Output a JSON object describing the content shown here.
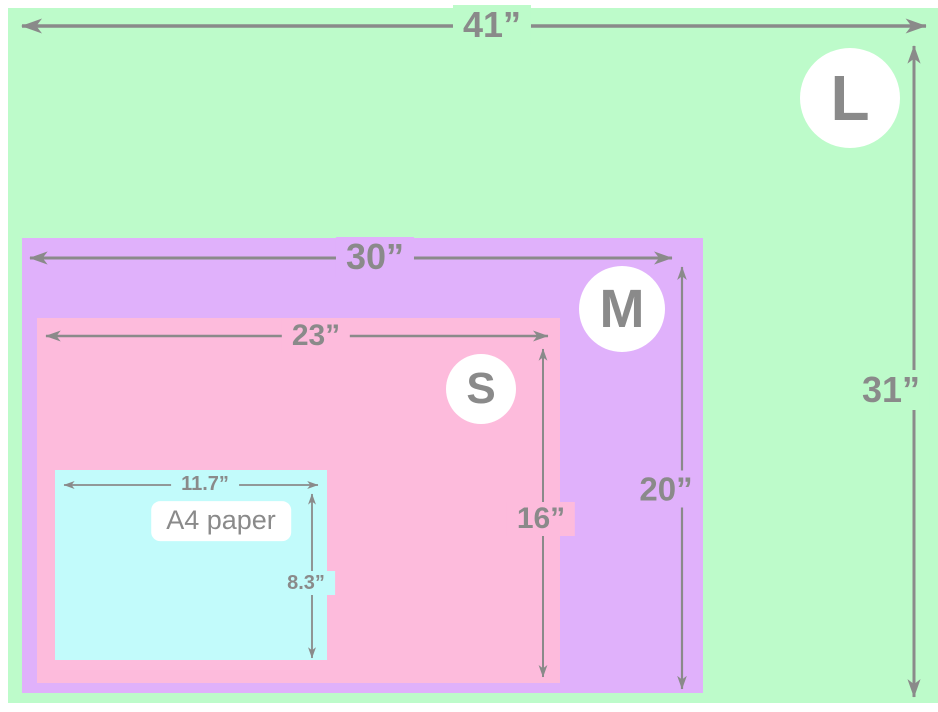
{
  "title": "Size comparison diagram with nested rectangles and A4 paper reference",
  "colors": {
    "background": "#ffffff",
    "size_l": "#bdfbca",
    "size_m": "#e0b1fb",
    "size_s": "#fdbbdc",
    "a4": "#c2fbfb",
    "annotation": "#8a8a8a",
    "badge_bg": "#ffffff"
  },
  "sizes": [
    {
      "id": "L",
      "badge": "L",
      "width": "41”",
      "height": "31”"
    },
    {
      "id": "M",
      "badge": "M",
      "width": "30”",
      "height": "20”"
    },
    {
      "id": "S",
      "badge": "S",
      "width": "23”",
      "height": "16”"
    },
    {
      "id": "A4",
      "name": "A4 paper",
      "width": "11.7”",
      "height": "8.3”"
    }
  ]
}
